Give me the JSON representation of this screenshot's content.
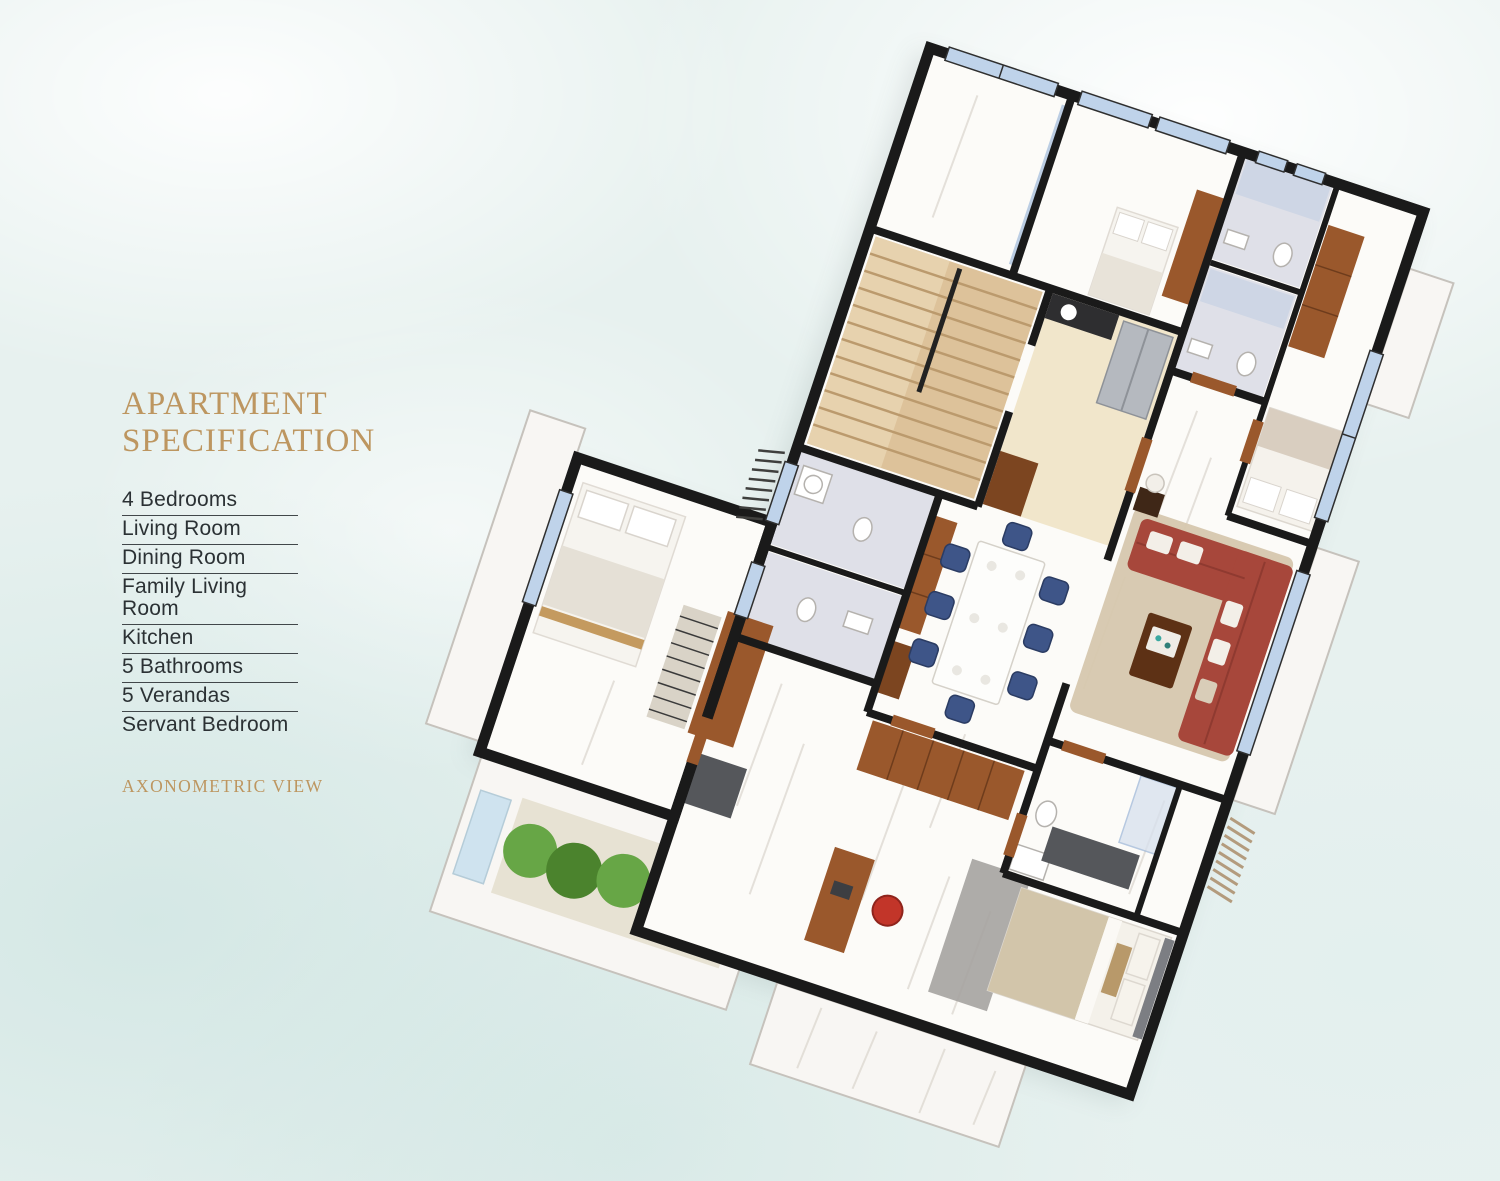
{
  "spec_panel": {
    "title_line1": "APARTMENT",
    "title_line2": "SPECIFICATION",
    "items": [
      "4 Bedrooms",
      "Living Room",
      "Dining Room",
      "Family Living Room",
      "Kitchen",
      "5 Bathrooms",
      "5 Verandas",
      "Servant Bedroom"
    ],
    "view_label": "AXONOMETRIC VIEW"
  },
  "floor_plan": {
    "type": "axonometric-3d-floor-plan-render",
    "rotation_deg": 18.4,
    "depicted_elements": [
      "black-outer-walls",
      "white-marble-floors",
      "travertine-staircase",
      "kitchen-with-fridge",
      "dining-table-with-blue-chairs",
      "wood-cabinets",
      "red-l-shaped-sofa",
      "beige-rug",
      "marble-bathrooms",
      "beds-with-pillows",
      "desk-with-red-chair",
      "garden-veranda-with-bushes",
      "window-glazing",
      "wood-doors",
      "exterior-louvers",
      "white-veranda-slabs"
    ],
    "colors": {
      "accent_gold": "#bd9660",
      "ink": "#2b3134",
      "wall": "#1a1a1a",
      "floor": "#fcfbf8",
      "slab": "#f8f6f3",
      "wood": "#9a582c",
      "wood_dark": "#7c4520",
      "sofa": "#a7473b",
      "rug": "#d6c7ae",
      "chair_blue": "#3e5588",
      "glass": "#bfd3ea",
      "tile": "#dfe0e8",
      "stairs": "#ddc29a",
      "stairs_line": "#bb9a6d",
      "green_a": "#67a646",
      "green_b": "#4b832d",
      "silver": "#b5b9bf",
      "chair_red": "#c23529",
      "bed_blanket": "#d2c5aa",
      "gray_dark": "#55575b",
      "headboard": "#7c7e83"
    }
  }
}
